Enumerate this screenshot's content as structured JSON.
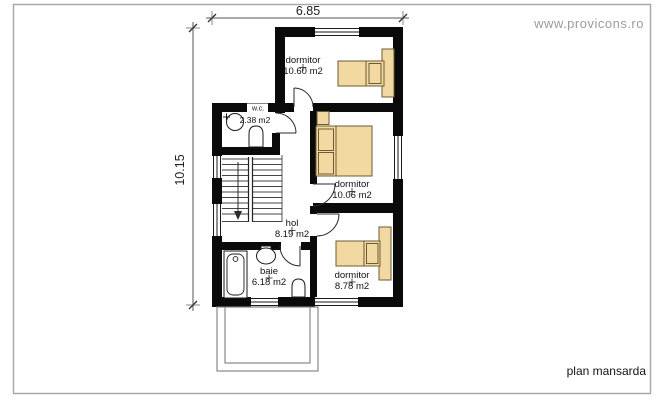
{
  "branding": {
    "watermark": "www.provicons.ro"
  },
  "caption": "plan mansarda",
  "dimensions": {
    "width": "6.85",
    "height": "10.15"
  },
  "rooms": [
    {
      "name": "dormitor",
      "area": "10.60 m2"
    },
    {
      "name": "dormitor",
      "area": "10.06 m2"
    },
    {
      "name": "dormitor",
      "area": "8.78 m2"
    },
    {
      "name": "hol",
      "area": "8.19 m2"
    },
    {
      "name": "baie",
      "area": "6.18 m2"
    },
    {
      "name": "w.c.",
      "area": "2.38 m2"
    }
  ],
  "colors": {
    "wall": "#0a0a0a",
    "furniture_fill": "#f2d9a2",
    "furniture_stroke": "#6b5b33",
    "frame_border": "#a9a9a9",
    "watermark_text": "#9b9b9b",
    "line": "#333333"
  }
}
